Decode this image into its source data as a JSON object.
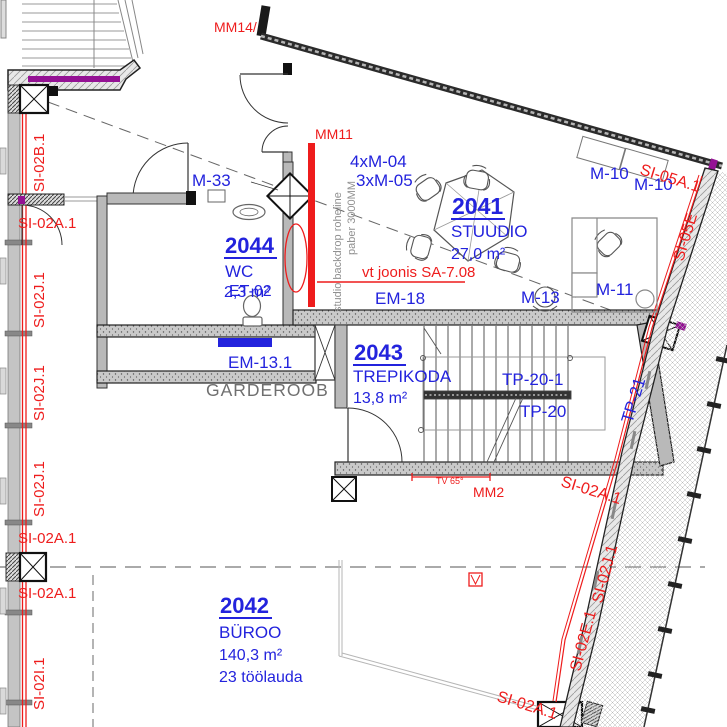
{
  "colors": {
    "accent_blue": "#2323dd",
    "accent_red": "#ee1c1c",
    "magenta": "#941294",
    "wall_gray": "#9c9c9c",
    "note_gray": "#909090"
  },
  "rooms": {
    "studio": {
      "num": "2041",
      "name": "STUUDIO",
      "area": "27,0 m²"
    },
    "office": {
      "num": "2042",
      "name": "BÜROO",
      "area": "140,3 m²",
      "desks": "23 töölauda"
    },
    "stair": {
      "num": "2043",
      "name": "TREPIKODA",
      "area": "13,8 m²"
    },
    "wc": {
      "num": "2044",
      "name": "WC",
      "area": "2,3 m²"
    }
  },
  "furniture": {
    "m33": "M-33",
    "m04": "4xM-04",
    "m05": "3xM-05",
    "m10_left": "M-10",
    "m10_right": "M-10",
    "m11": "M-11",
    "m13": "M-13"
  },
  "elements": {
    "em18": "EM-18",
    "em13_1": "EM-13.1",
    "et02": "ET-02",
    "garderoob": "GARDEROOB",
    "tp20_1": "TP-20-1",
    "tp20": "TP-20",
    "tp21": "TP-21",
    "tv_note": "TV 65°",
    "mm14": "MM14/",
    "mm11": "MM11",
    "mm2": "MM2",
    "backdrop_note_line1": "studio backdrop roheline",
    "backdrop_note_line2": "paber 3000MM",
    "drawing_ref": "vt joonis SA-7.08"
  },
  "fire_marks": {
    "si02b1": "SI-02B.1",
    "si02a1": "SI-02A.1",
    "si02j1": "SI-02J.1",
    "si02i1": "SI-02I.1",
    "si02e1": "SI-02E.1",
    "si05a1": "SI-05A.1",
    "si05e": "SI-05E"
  }
}
